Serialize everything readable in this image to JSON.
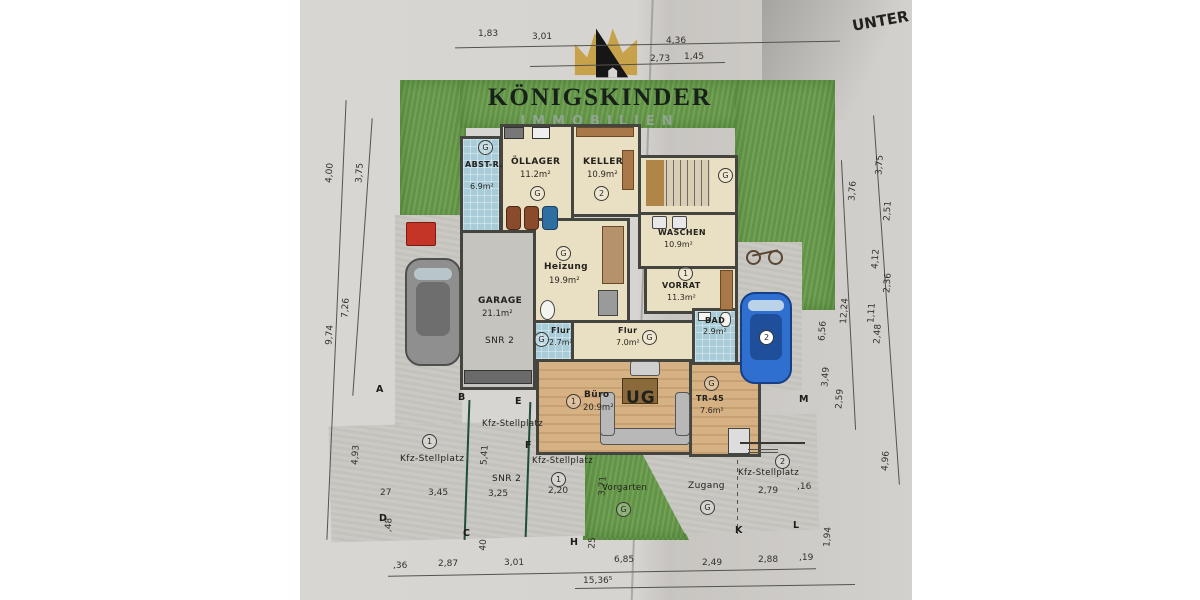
{
  "photo": {
    "corner_label": "UNTER"
  },
  "logo": {
    "title": "KÖNIGSKINDER",
    "subtitle": "IMMOBILIEN",
    "colors": {
      "gold": "#c8a24b",
      "dark": "#161616",
      "subtitle_green": "#8fa58f"
    }
  },
  "floor_label": "UG",
  "rooms": {
    "abst": {
      "name": "ABST-R.",
      "area": "6.9m²",
      "badge": "G"
    },
    "oellager": {
      "name": "ÖLLAGER",
      "area": "11.2m²",
      "badge": "G"
    },
    "keller": {
      "name": "KELLER",
      "area": "10.9m²",
      "badge": "2"
    },
    "stairs": {
      "badge": "G"
    },
    "waschen": {
      "name": "WASCHEN",
      "area": "10.9m²",
      "badge": "G"
    },
    "heizung": {
      "name": "Heizung",
      "area": "19.9m²",
      "badge": "G"
    },
    "vorrat": {
      "name": "VORRAT",
      "area": "11.3m²",
      "badge": "1"
    },
    "flur_small": {
      "name": "Flur",
      "area": "2.7m²",
      "badge": "G"
    },
    "flur_main": {
      "name": "Flur",
      "area": "7.0m²",
      "badge": "G"
    },
    "bad": {
      "name": "BAD",
      "area": "2.9m²"
    },
    "buero": {
      "name": "Büro",
      "area": "20.9m²",
      "badge": "1"
    },
    "tr": {
      "name": "TR-45",
      "area": "7.6m²",
      "badge": "G"
    },
    "garage": {
      "name": "GARAGE",
      "area": "21.1m²",
      "snr": "SNR 2"
    }
  },
  "outdoor": {
    "parking_left": {
      "label": "Kfz-Stellplatz",
      "badge": "1"
    },
    "parking_top": {
      "label": "Kfz-Stellplatz"
    },
    "parking_mid": {
      "label": "Kfz-Stellplatz",
      "snr": "SNR 2",
      "badge": "1"
    },
    "parking_right": {
      "label": "Kfz-Stellplatz",
      "badge": "2"
    },
    "vorgarten": {
      "label": "Vorgarten",
      "badge": "G"
    },
    "zugang": {
      "label": "Zugang",
      "badge": "G"
    }
  },
  "dims": {
    "t1": "1,83",
    "t2": "3,01",
    "t3": "4,36",
    "t4": "2,73",
    "t5": "1,45",
    "l1": "4,00",
    "l2": "3,75",
    "l3": "7,26",
    "l4": "9,74",
    "l5": "4,93",
    "l6": "27",
    "l7": ",48",
    "r1": "3,75",
    "r2": "3,76",
    "r3": "2,51",
    "r4": "4,12",
    "r5": "2,36",
    "r6": "1,11",
    "r7": "2,48",
    "r8": "6,56",
    "r9": "12,24",
    "r10": "3,49",
    "r11": "2,59",
    "r12": "4,96",
    "r13": "1,94",
    "b1": ",36",
    "b2": "2,87",
    "b3": "3,01",
    "b4": "6,85",
    "b5": "15,36⁵",
    "b6": "2,49",
    "b7": "2,88",
    "b8": ",19",
    "b9": "40",
    "b10": "25",
    "i1": "5,41",
    "i2": "3,45",
    "i3": "3,25",
    "i4": "2,20",
    "i5": "2,79",
    "i6": ",16",
    "i7": "3,71"
  },
  "points": {
    "a": "A",
    "b": "B",
    "c": "C",
    "d": "D",
    "e": "E",
    "f": "F",
    "h": "H",
    "k": "K",
    "l": "L",
    "m": "M"
  }
}
